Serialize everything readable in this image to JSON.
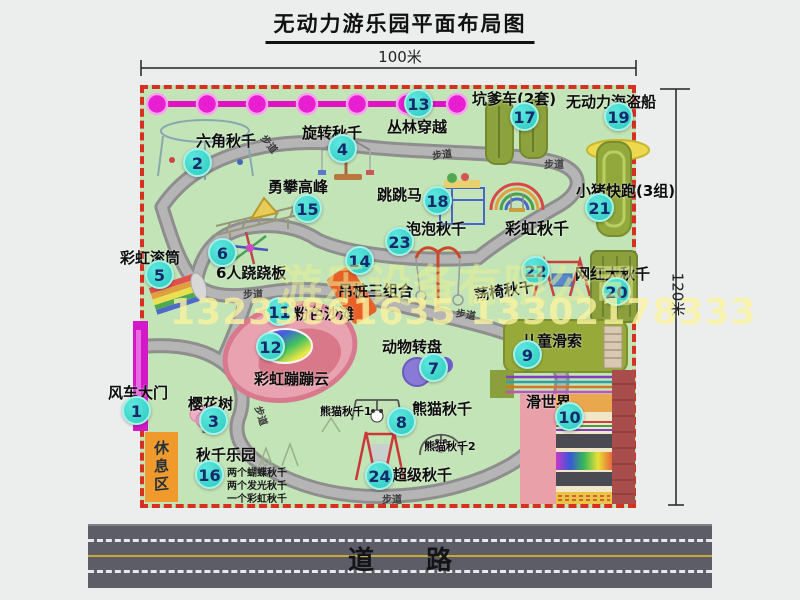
{
  "title": "无动力游乐园平面布局图",
  "dimensions": {
    "width": "100米",
    "height": "120米"
  },
  "road": {
    "label": "道　　路"
  },
  "watermark": {
    "company": "游乐设备有限公司",
    "phone": "13233861635 13302178333"
  },
  "rest_area": "休息区",
  "footpath": "步道",
  "attractions": [
    {
      "num": "1",
      "label": "风车大门"
    },
    {
      "num": "2",
      "label": "六角秋千"
    },
    {
      "num": "3",
      "label": "樱花树"
    },
    {
      "num": "4",
      "label": "旋转秋千"
    },
    {
      "num": "5",
      "label": "彩虹滚筒"
    },
    {
      "num": "6",
      "label": "6人跷跷板"
    },
    {
      "num": "7",
      "label": "动物转盘"
    },
    {
      "num": "8",
      "label": "熊猫秋千"
    },
    {
      "num": "9",
      "label": "儿童滑索"
    },
    {
      "num": "10",
      "label": "滑世界"
    },
    {
      "num": "11",
      "label": "粉色沙滩"
    },
    {
      "num": "12",
      "label": "彩虹蹦蹦云"
    },
    {
      "num": "13",
      "label": "丛林穿越"
    },
    {
      "num": "14",
      "label": "吊桩三组合"
    },
    {
      "num": "15",
      "label": "勇攀高峰"
    },
    {
      "num": "16",
      "label": "秋千乐园"
    },
    {
      "num": "17",
      "label": "坑爹车(2套)"
    },
    {
      "num": "18",
      "label": "跳跳马"
    },
    {
      "num": "19",
      "label": "无动力海盗船"
    },
    {
      "num": "20",
      "label": "网红大秋千"
    },
    {
      "num": "21",
      "label": "小猪快跑(3组)"
    },
    {
      "num": "22",
      "label": "荡椅秋千"
    },
    {
      "num": "23",
      "label": "泡泡秋千"
    },
    {
      "num": "24",
      "label": "超级秋千"
    }
  ],
  "unnumbered": {
    "rainbow_swing": "彩虹秋千",
    "panda_swing_1": "熊猫秋千1",
    "panda_swing_2": "熊猫秋千2"
  },
  "swing_notes": [
    "两个蝴蝶秋千",
    "两个发光秋千",
    "一个彩虹秋千"
  ],
  "colors": {
    "map_green": "#c3e4b6",
    "border_red": "#d63020",
    "badge_teal": "#3bd9cc",
    "zipline_magenta": "#e020cd",
    "gate_magenta": "#d318c8",
    "road_gray": "#5d5d68",
    "rest_orange": "#f09a2e",
    "watermark_yellow": "#f5eea0"
  }
}
